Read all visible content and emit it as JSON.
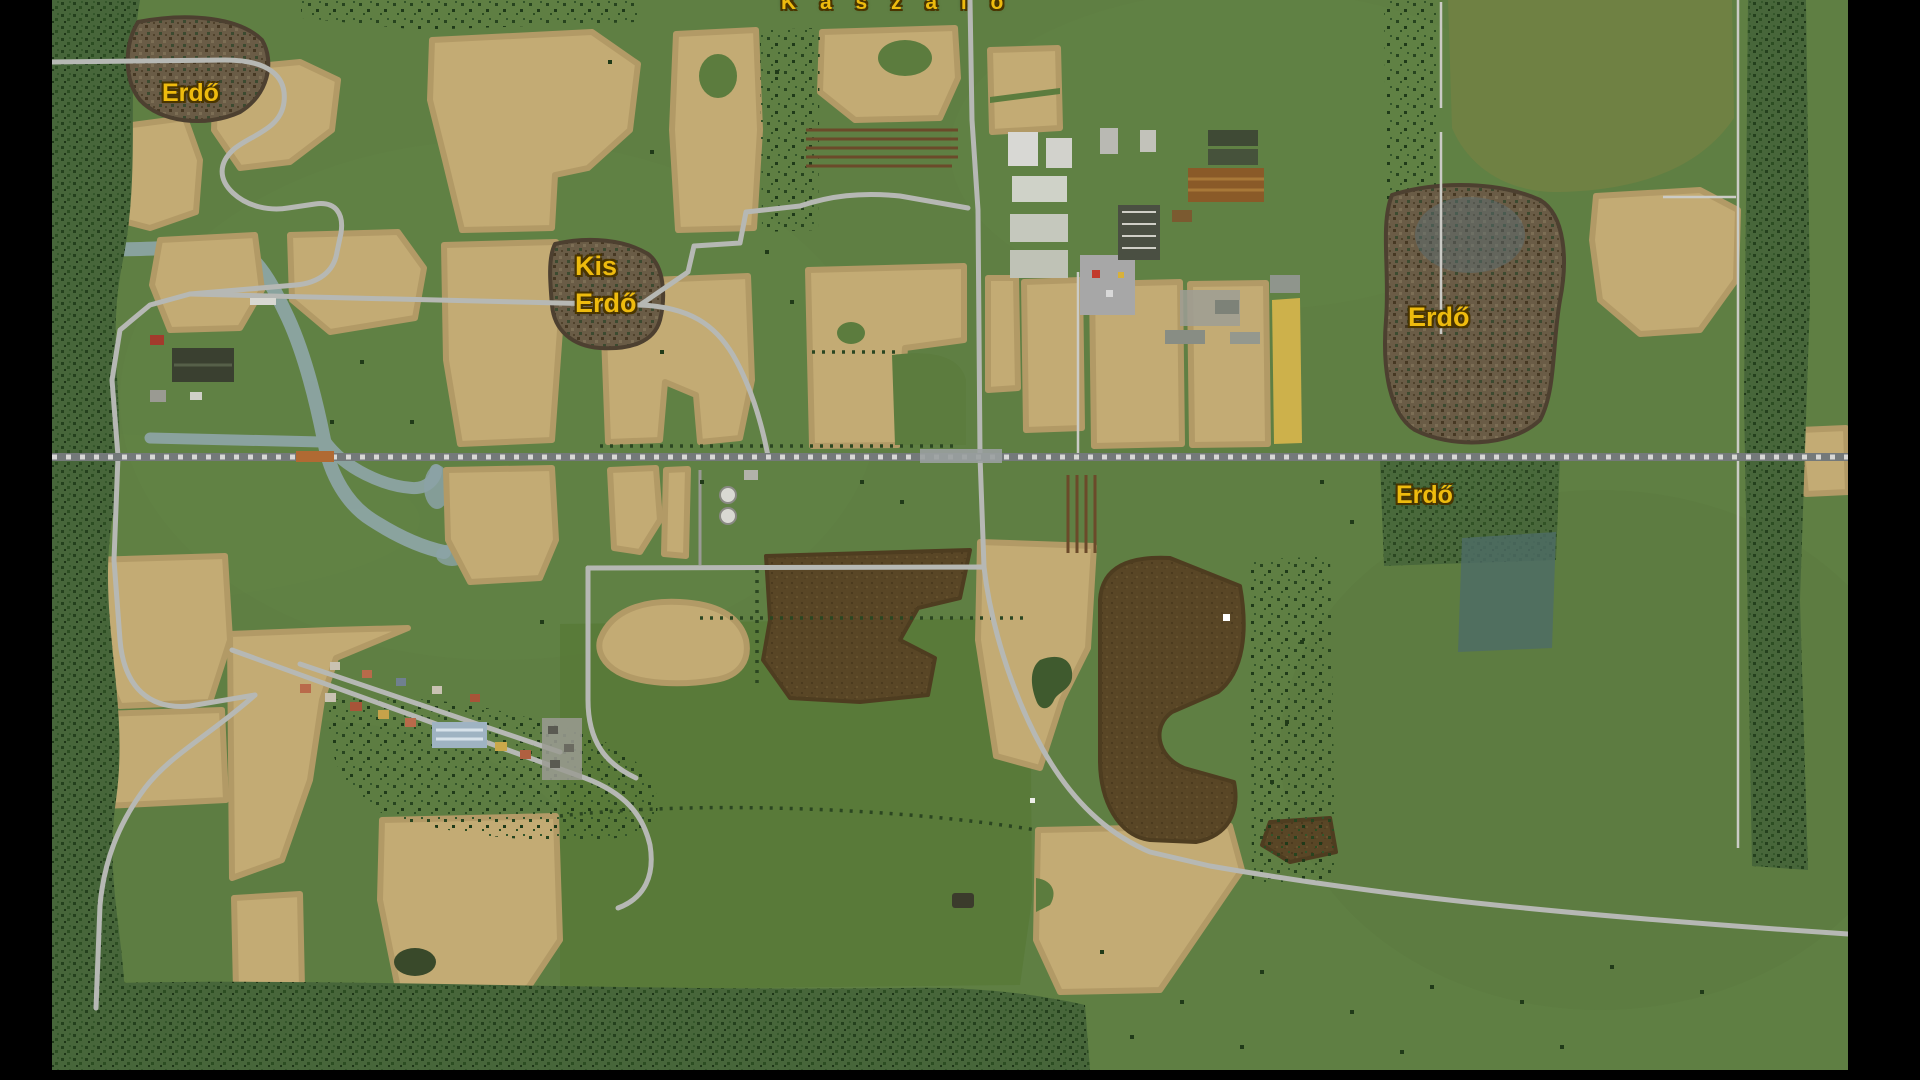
{
  "scene": {
    "description": "top-down farming game world map with field, forest and meadow areas",
    "view": "overhead map"
  },
  "labels": {
    "kaszalo": "K a s z a l o",
    "erdo_nw": "Erdő",
    "kis_erdo_line1": "Kis",
    "kis_erdo_line2": "Erdő",
    "erdo_e": "Erdő",
    "erdo_se": "Erdő"
  },
  "colors": {
    "label_yellow": "#eebb0e",
    "label_outline": "#4a3500",
    "grass_base": "#5f7f43",
    "meadow_olive": "#6f8143",
    "meadow_dark": "#597a39",
    "field_tan": "#c3ab74",
    "field_gold": "#cdb14b",
    "field_plowed_brown": "#594626",
    "forest_green_dark": "#2b4a20",
    "forest_brown": "#6a5c46",
    "water_stream": "#90a7ab",
    "water_teal": "#4e6b66",
    "road_gray": "#b6b8b4",
    "railway_gray": "#74797a",
    "railway_ties": "#d8d8d6",
    "railway_crossing_orange": "#b06a33",
    "letterbox_black": "#000000"
  }
}
